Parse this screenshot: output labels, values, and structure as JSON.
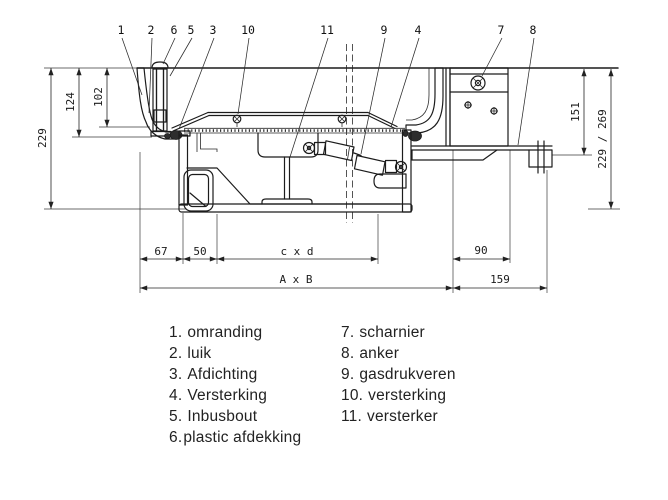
{
  "drawing": {
    "title": "hatch cross-section technical drawing",
    "callouts": [
      "1",
      "2",
      "6",
      "5",
      "3",
      "10",
      "11",
      "9",
      "4",
      "7",
      "8"
    ],
    "dims": {
      "d229": "229",
      "d124": "124",
      "d102": "102",
      "d151": "151",
      "d229269": "229 / 269",
      "d67": "67",
      "d50": "50",
      "dcxd": "c x d",
      "d90": "90",
      "dAxB": "A x B",
      "d159": "159"
    }
  },
  "legend": {
    "items_left": [
      {
        "num": "1.",
        "label": "omranding"
      },
      {
        "num": "2.",
        "label": "luik"
      },
      {
        "num": "3.",
        "label": "Afdichting"
      },
      {
        "num": "4.",
        "label": "Versterking"
      },
      {
        "num": "5.",
        "label": "Inbusbout"
      },
      {
        "num": "6.",
        "label": "plastic afdekking"
      }
    ],
    "items_right": [
      {
        "num": "7.",
        "label": "scharnier"
      },
      {
        "num": "8.",
        "label": "anker"
      },
      {
        "num": "9.",
        "label": "gasdrukveren"
      },
      {
        "num": "10.",
        "label": "versterking"
      },
      {
        "num": "11.",
        "label": "versterker"
      }
    ]
  },
  "colors": {
    "line": "#1c1c1c",
    "dim_text": "#1b1b1b",
    "background": "#ffffff"
  }
}
